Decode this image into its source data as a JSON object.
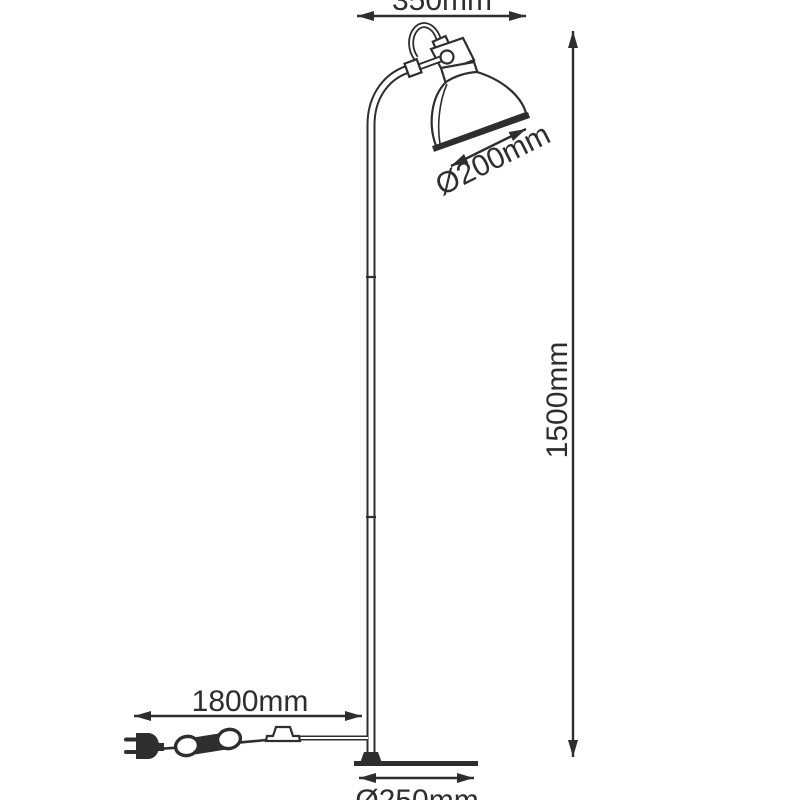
{
  "colors": {
    "line": "#2e2e2e",
    "background": "#ffffff"
  },
  "dimensions": {
    "head_width": "350mm",
    "shade_diameter": "Ø200mm",
    "height": "1500mm",
    "cable_length": "1800mm",
    "base_diameter": "Ø250mm"
  }
}
